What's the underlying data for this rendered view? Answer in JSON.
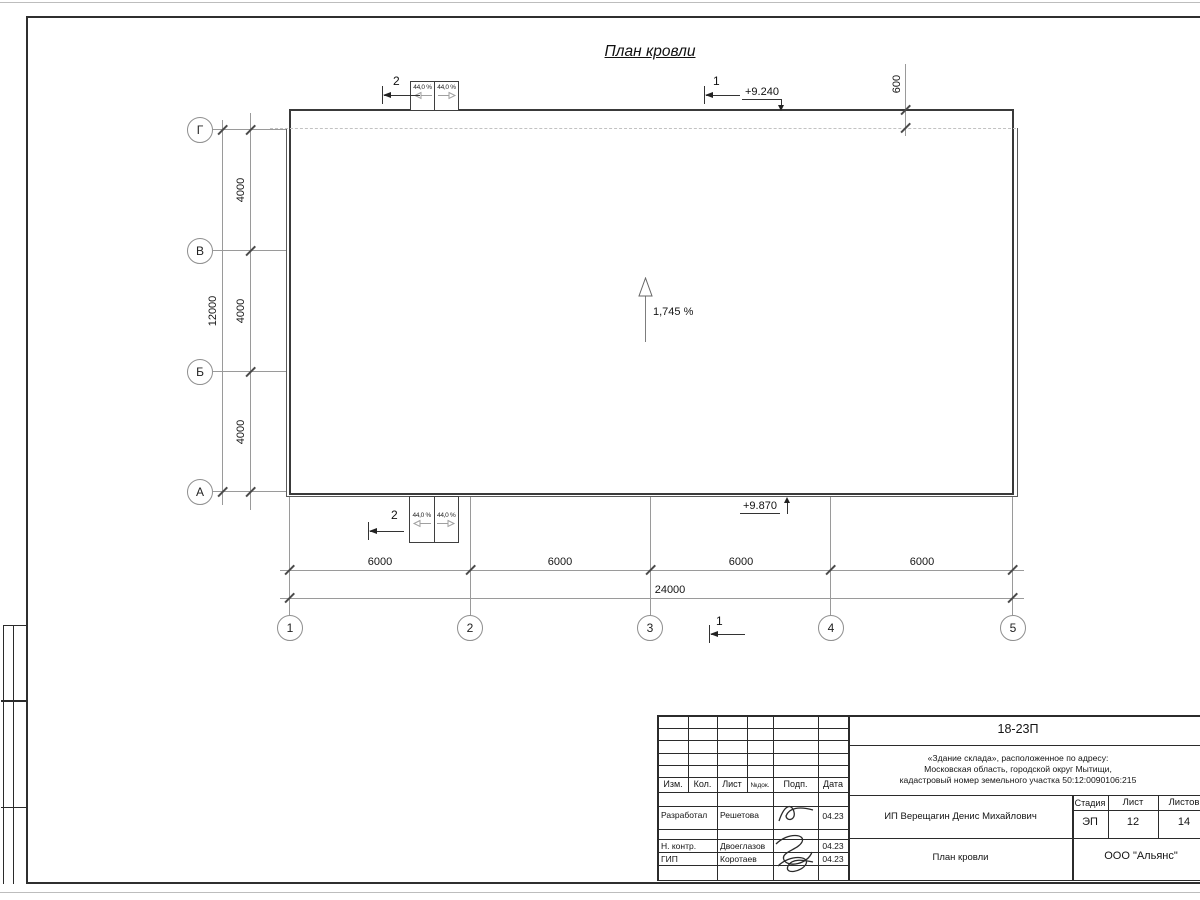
{
  "drawing": {
    "title": "План кровли",
    "slope_center": "1,745 %",
    "canopy_slope": "44,0 %",
    "elev_top": "+9.240",
    "elev_bottom": "+9.870",
    "parapet_offset": "600",
    "section1": "1",
    "section2": "2",
    "row_axes": [
      "Г",
      "В",
      "Б",
      "А"
    ],
    "col_axes": [
      "1",
      "2",
      "3",
      "4",
      "5"
    ],
    "v_dims": [
      "4000",
      "4000",
      "4000"
    ],
    "v_total": "12000",
    "h_dims": [
      "6000",
      "6000",
      "6000",
      "6000"
    ],
    "h_total": "24000"
  },
  "titleblock": {
    "doc_code": "18-23П",
    "address_line1": "«Здание склада», расположенное по адресу:",
    "address_line2": "Московская область, городской округ Мытищи,",
    "address_line3": "кадастровый номер земельного участка 50:12:0090106:215",
    "col_headers": {
      "izm": "Изм.",
      "kol": "Кол.",
      "list": "Лист",
      "ndok": "№док.",
      "podp": "Подп.",
      "data": "Дата"
    },
    "roles": [
      {
        "role": "Разработал",
        "name": "Решетова",
        "date": "04.23"
      },
      {
        "role": "Н. контр.",
        "name": "Двоеглазов",
        "date": "04.23"
      },
      {
        "role": "ГИП",
        "name": "Коротаев",
        "date": "04.23"
      }
    ],
    "client": "ИП Верещагин Денис Михайлович",
    "sheet_name": "План кровли",
    "org": "ООО \"Альянс\"",
    "stage_label": "Стадия",
    "stage_value": "ЭП",
    "list_label": "Лист",
    "list_value": "12",
    "listov_label": "Листов",
    "listov_value": "14"
  }
}
